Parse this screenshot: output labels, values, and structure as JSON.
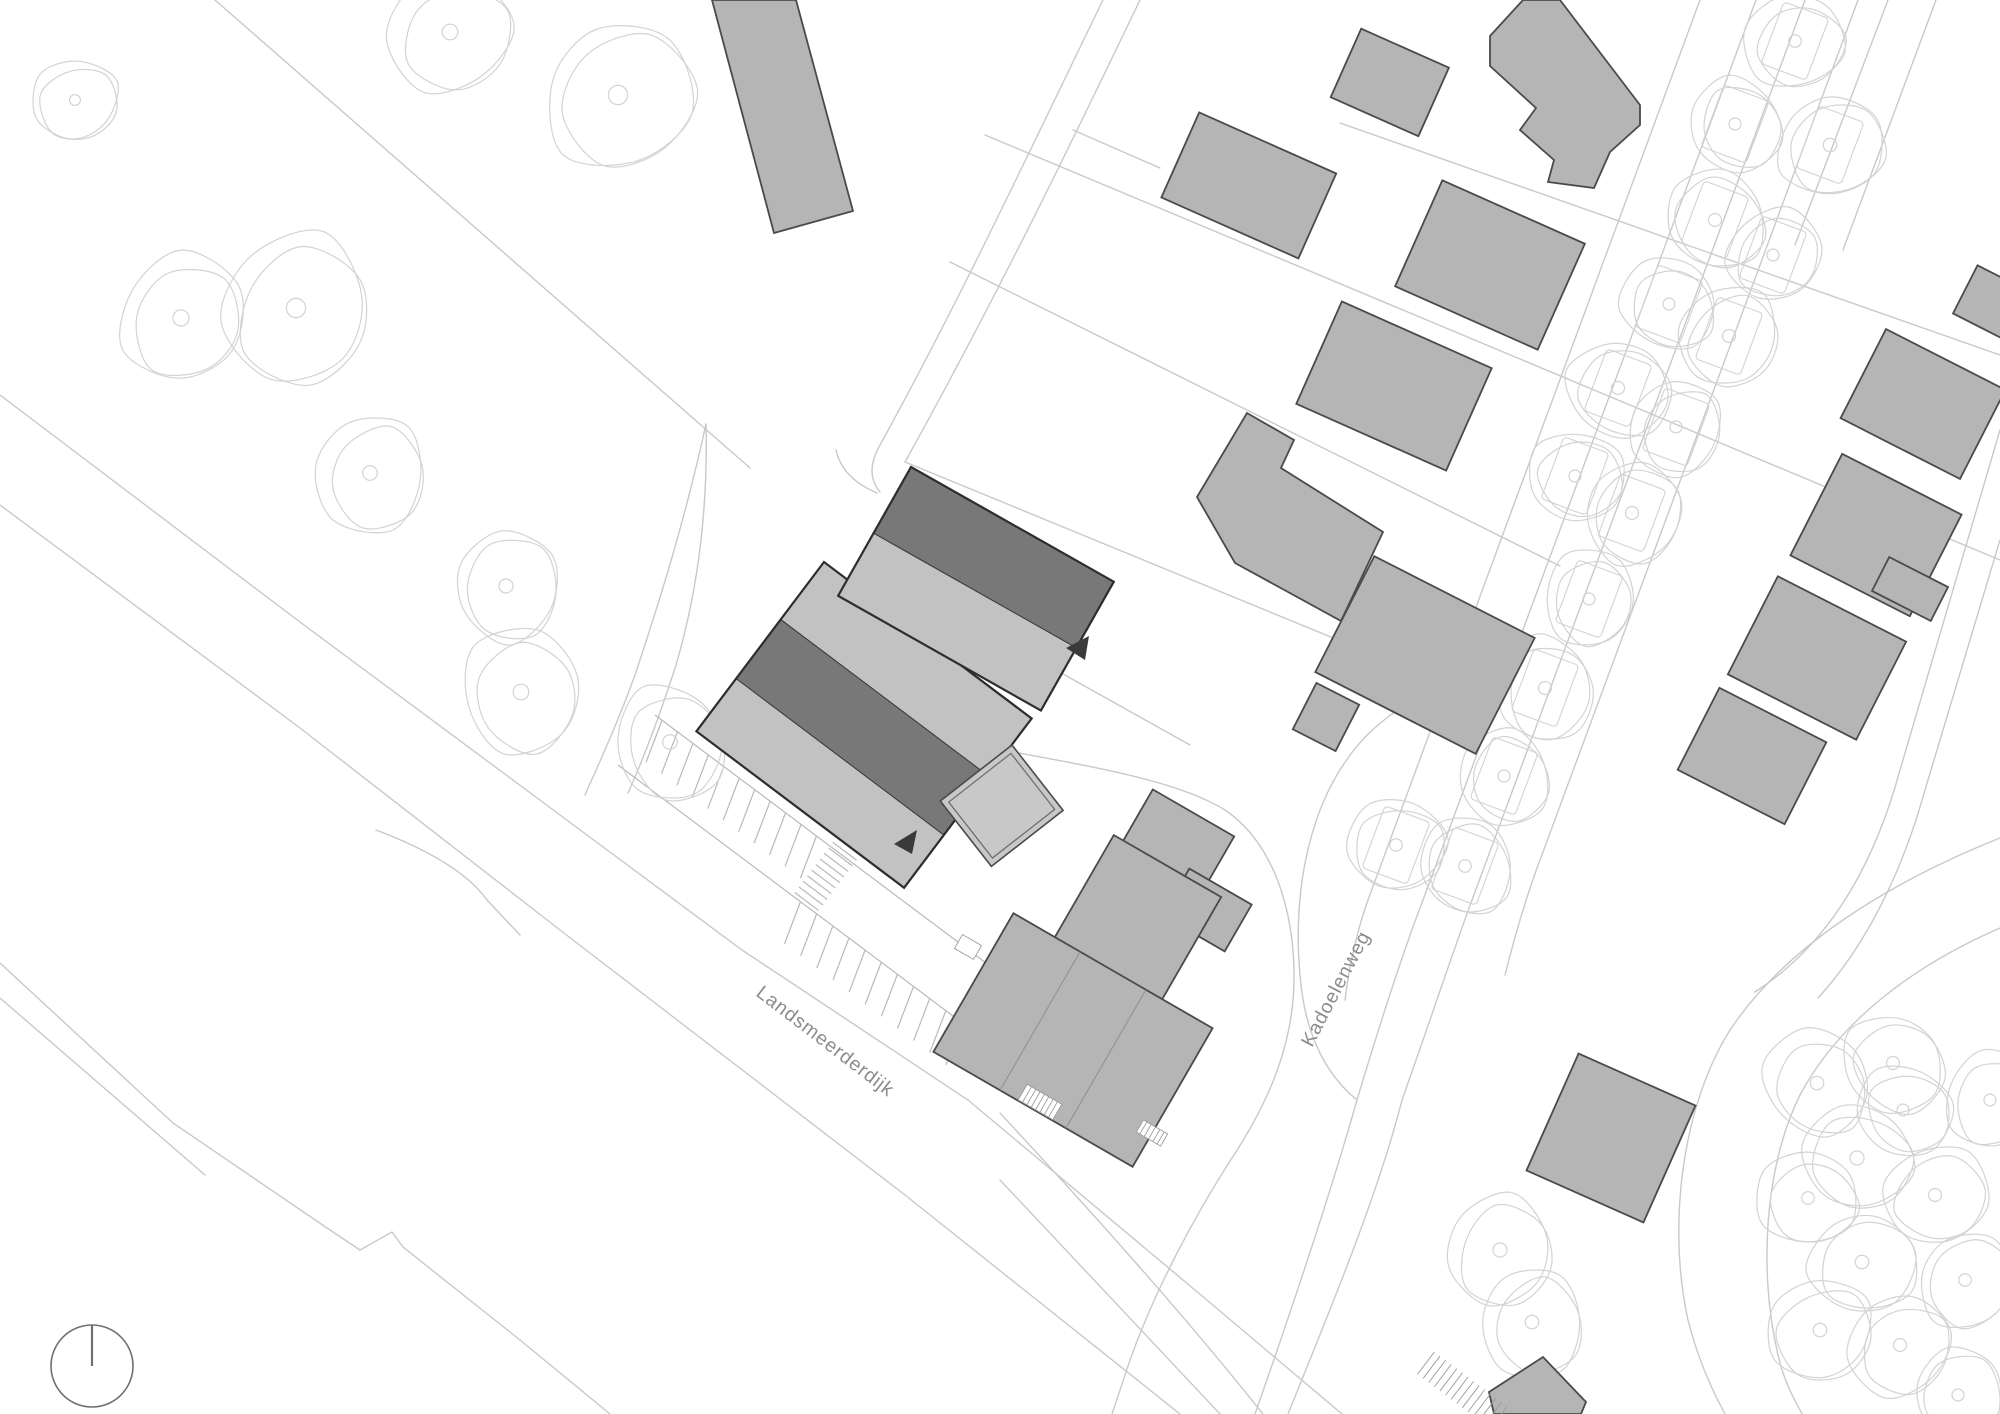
{
  "plan": {
    "streets": [
      {
        "label": "Landsmeerderdijk"
      },
      {
        "label": "Kadoelenweg"
      }
    ],
    "symbols": {
      "north_indicator": "north-circle-icon",
      "entrance_arrow": "entrance-arrow-icon",
      "tree": "tree-canopy-icon"
    },
    "colors": {
      "background": "#ffffff",
      "map_line": "#c9c9c9",
      "tree_line": "#d3d3d3",
      "context_building_fill": "#b5b5b5",
      "context_building_stroke": "#4a4a4a",
      "project_roof_dark": "#787878",
      "project_roof_light": "#c2c2c2",
      "project_outline": "#2d2d2d",
      "annex_fill": "#c8c8c8",
      "arrow": "#3a3a3a",
      "street_label": "#8c8c8c",
      "north_indicator": "#707070"
    }
  }
}
